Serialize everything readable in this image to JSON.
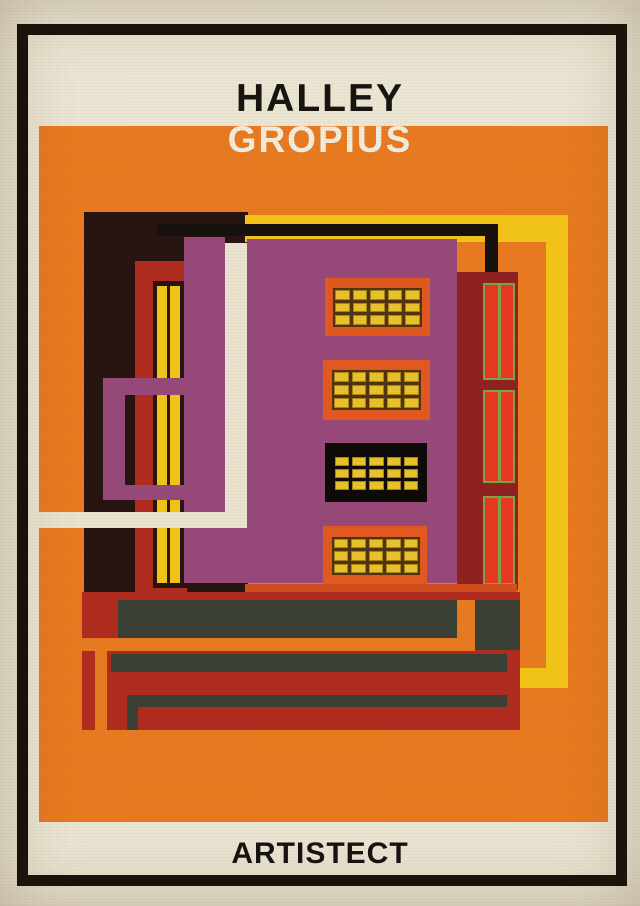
{
  "poster": {
    "artist_name": "HALLEY",
    "architect_name": "GROPIUS",
    "brand": "ARTISTECT"
  },
  "colors": {
    "paper": "#ebe5d3",
    "cream": "#e9e3d0",
    "frame_black": "#16110d",
    "title_black": "#171310",
    "title_white": "#f2ecdc",
    "orange_bg": "#e87a20",
    "purple": "#97497a",
    "dark_brown": "#271310",
    "crimson": "#b02c1e",
    "maroon": "#8f2220",
    "bright_red": "#d44d1c",
    "strip_red": "#e8391f",
    "olive_green": "#7ba348",
    "yellow": "#f2c417",
    "pane_yellow": "#eac229",
    "pane_gap": "#523310",
    "window_box_orange": "#e2591f",
    "box_black": "#0d0a07",
    "slate": "#3b4036"
  },
  "illustration": {
    "window_grid": {
      "cols": 5,
      "rows": 3
    },
    "window_box_count": 4,
    "tower_strip_sections": 3,
    "strips_per_section": 2
  }
}
